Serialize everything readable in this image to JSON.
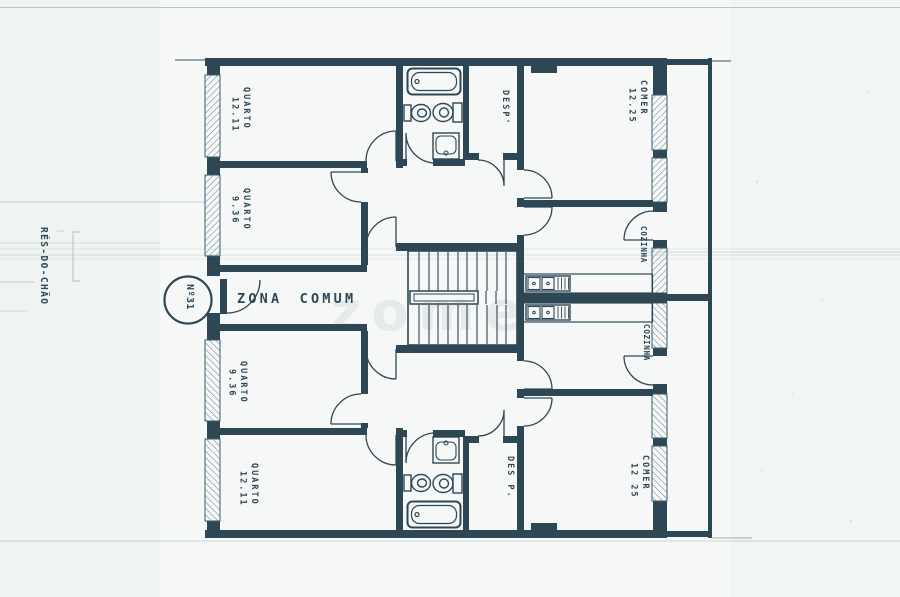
{
  "plan": {
    "floor_label": "RÉS-DO-CHÃO",
    "unit_number": "Nº31",
    "common_zone_label": "ZONA COMUM",
    "watermark": "zome",
    "rooms": {
      "quarto_top_large": {
        "name": "QUARTO",
        "area": "12.11"
      },
      "quarto_top_small": {
        "name": "QUARTO",
        "area": "9.36"
      },
      "desp_top": {
        "name": "DESP'"
      },
      "comer_top": {
        "name": "COMER",
        "area": "12.25"
      },
      "cozinha_top": {
        "name": "COZINHA"
      },
      "cozinha_bottom": {
        "name": "COZINHA"
      },
      "quarto_bottom_small": {
        "name": "QUARTO",
        "area": "9.36"
      },
      "quarto_bottom_large": {
        "name": "QUARTO",
        "area": "12.11"
      },
      "desp_bottom": {
        "name": "DES P."
      },
      "comer_bottom": {
        "name": "COMER",
        "area": "12 25"
      }
    },
    "colors": {
      "ink": "#2d4755",
      "ink_light": "#5a7886",
      "faint_line": "#8fa8b0",
      "paper": "#f6f8f7"
    }
  }
}
